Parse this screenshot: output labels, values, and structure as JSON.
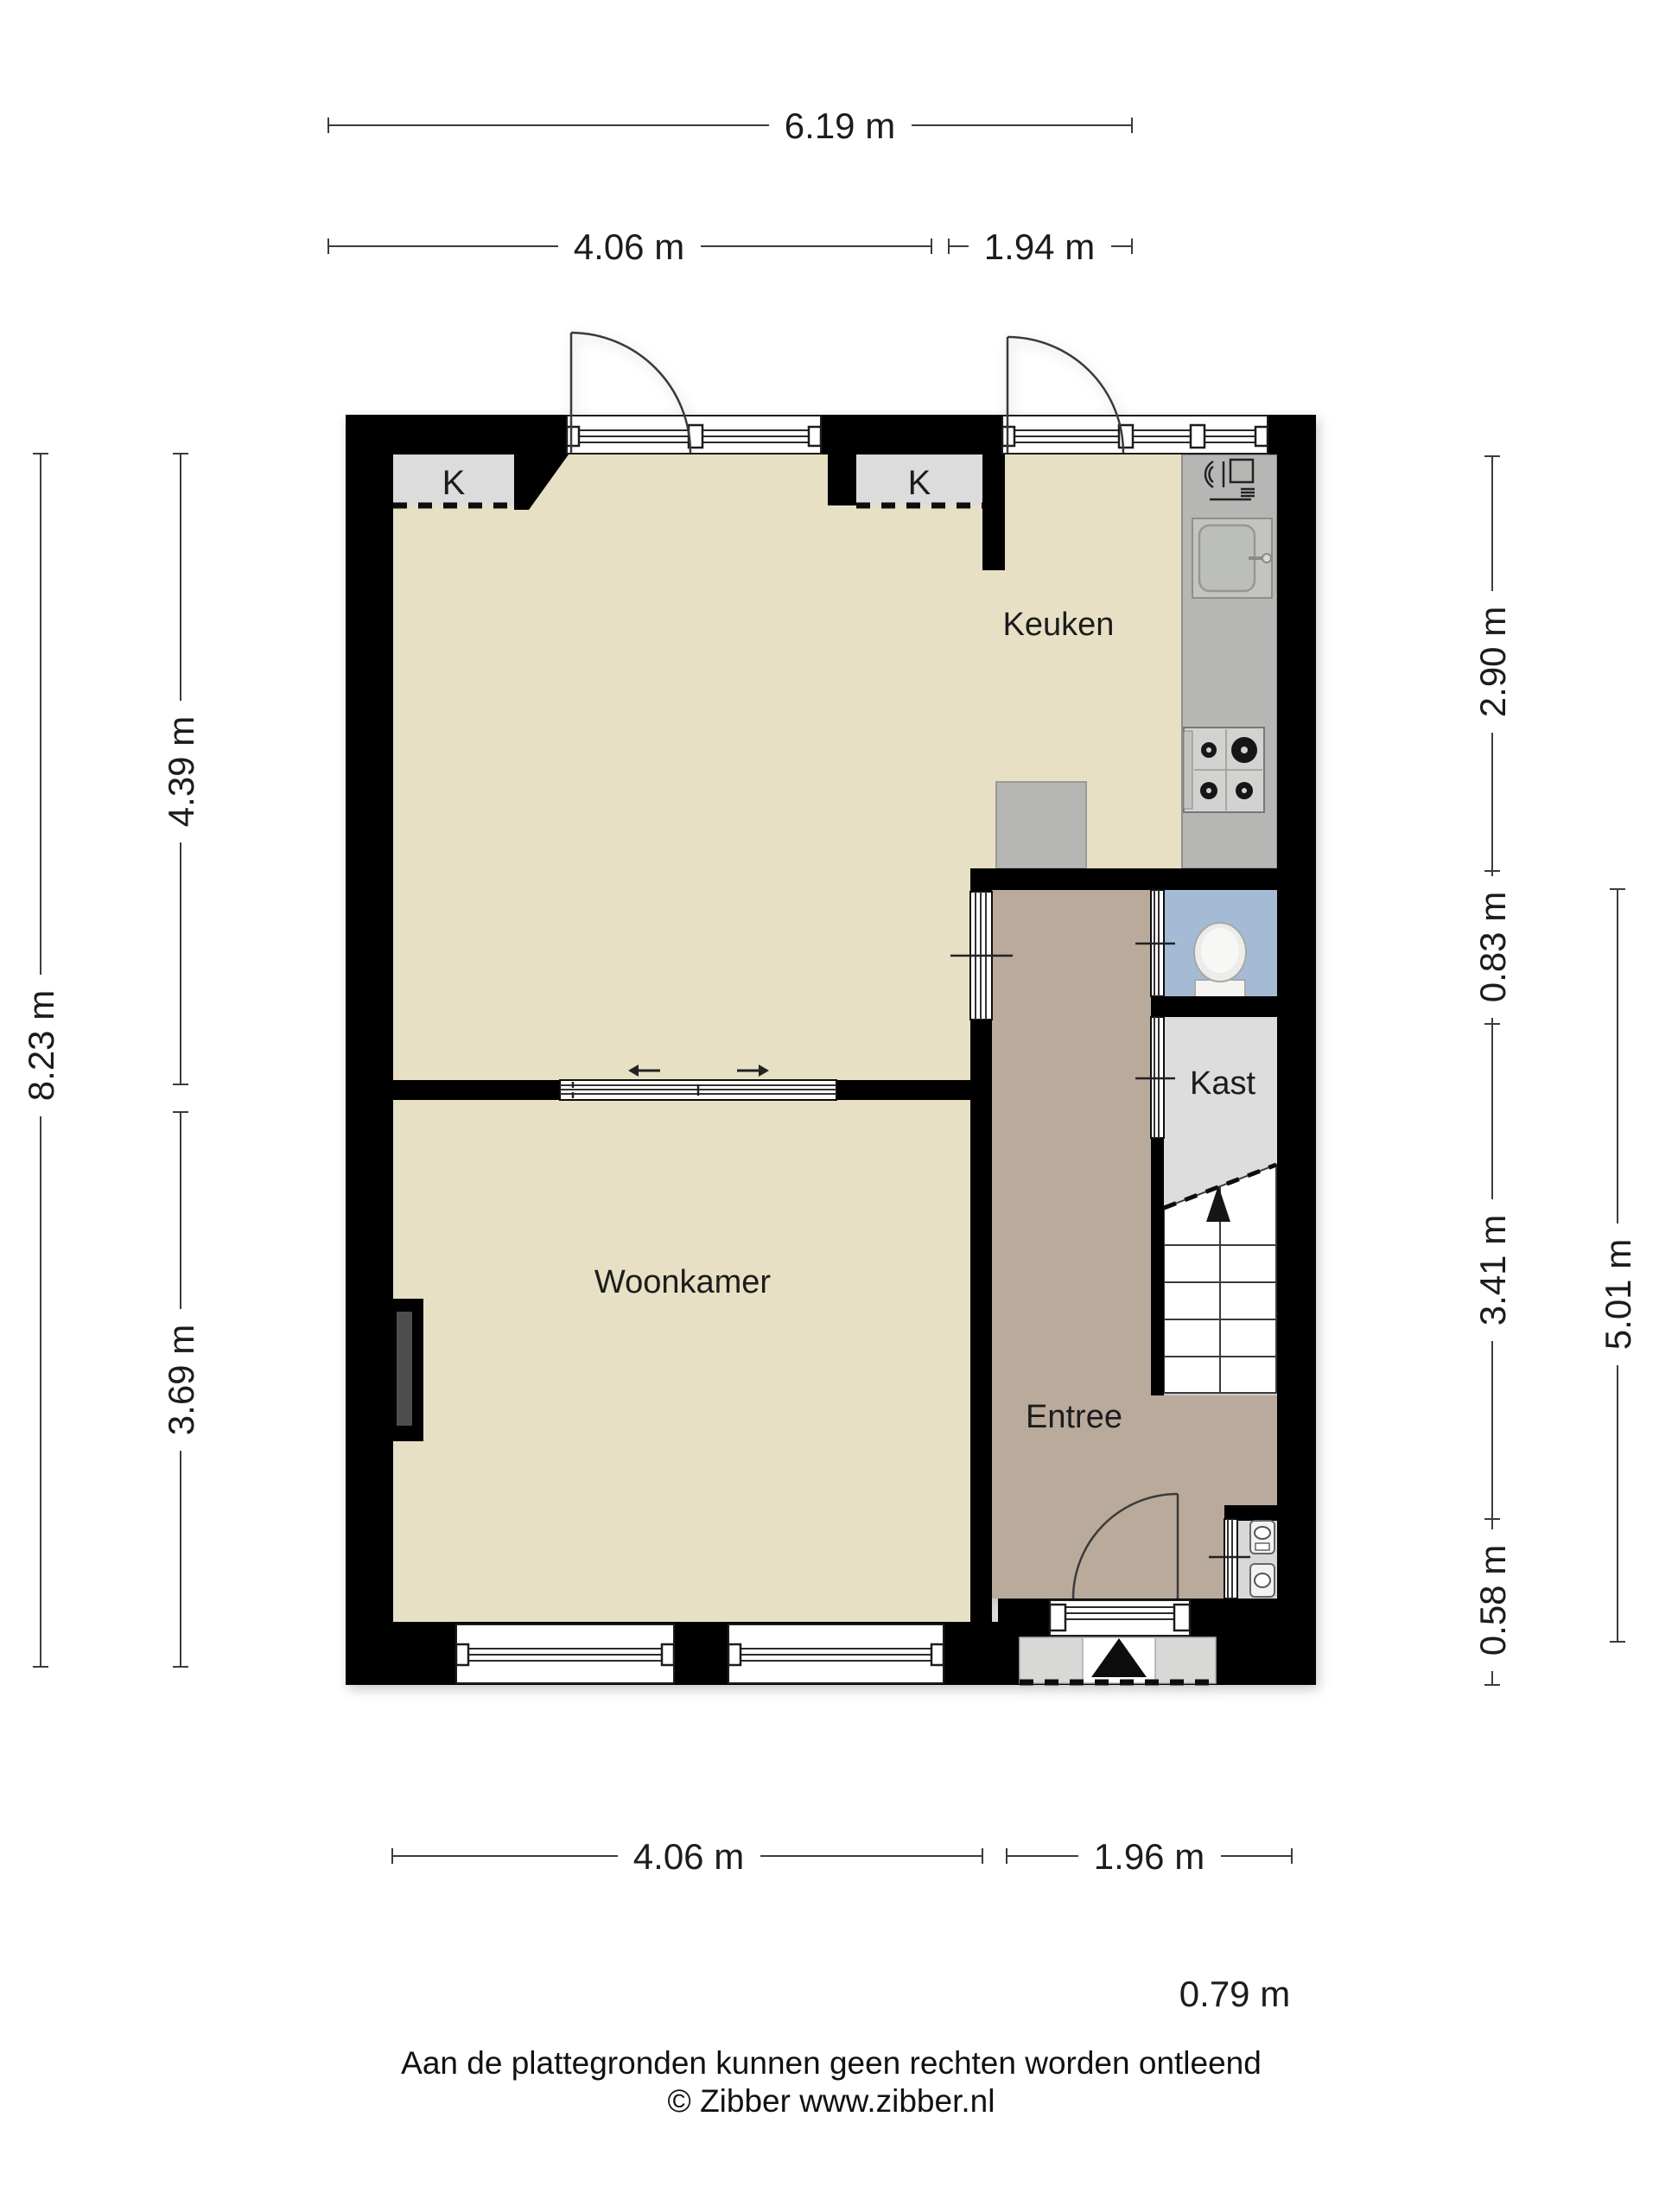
{
  "title": "Floor plan ground floor (plattegrond begane grond)",
  "colors": {
    "background": "#ffffff",
    "wall": "#050505",
    "floor_living": "#e8e0c5",
    "floor_entree": "#b9aa9b",
    "floor_toilet": "#a5bad4",
    "floor_kast": "#dddddd",
    "counter_grey": "#b6b6b4",
    "porch_grey": "#d8d8d6"
  },
  "room_labels": {
    "keuken": "Keuken",
    "woonkamer": "Woonkamer",
    "entree": "Entree",
    "kast": "Kast"
  },
  "closets": {
    "left": "K",
    "right": "K"
  },
  "dimensions": {
    "top": [
      {
        "label": "6.19 m"
      },
      {
        "label": "4.06 m"
      },
      {
        "label": "1.94 m"
      }
    ],
    "bottom": [
      {
        "label": "4.06 m"
      },
      {
        "label": "1.96 m"
      },
      {
        "label": "0.79 m"
      }
    ],
    "left": [
      {
        "label": "8.23 m"
      },
      {
        "label": "4.39 m"
      },
      {
        "label": "3.69 m"
      }
    ],
    "right": [
      {
        "label": "2.90 m"
      },
      {
        "label": "0.83 m"
      },
      {
        "label": "3.41 m"
      },
      {
        "label": "0.58 m"
      },
      {
        "label": "5.01 m"
      }
    ]
  },
  "icons": [
    "stairs-up-arrow-icon",
    "entrance-arrow-icon",
    "toilet-icon",
    "sink-icon",
    "stove-icon",
    "dishwasher-icon",
    "meter-icons",
    "fireplace-chimney",
    "sliding-door-arrows"
  ],
  "footer": {
    "line1": "Aan de plattegronden kunnen geen rechten worden ontleend",
    "line2": "© Zibber www.zibber.nl"
  }
}
